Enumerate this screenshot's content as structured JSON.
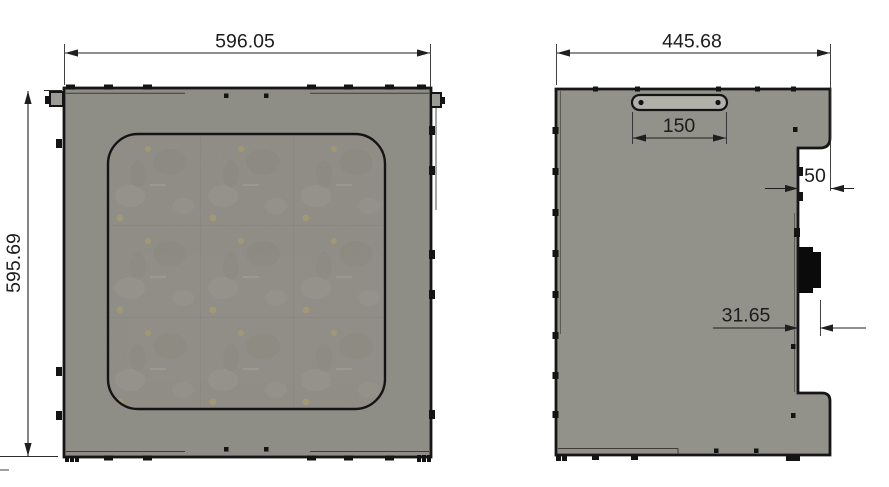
{
  "drawing": {
    "background": "#ffffff",
    "colors": {
      "outline": "#161616",
      "front_panel_fill": "#8e8d86",
      "side_panel_fill": "#92918a",
      "window_fill": "#8f8d85",
      "window_border": "#141414",
      "handle_fill": "#b2b1a9",
      "hardware_fill": "#9b9a93",
      "connector_fill": "#0b0b0b",
      "dim_line": "#1f1f1f",
      "dim_text": "#1c1c1c"
    },
    "dimensions": {
      "front_width": "596.05",
      "front_height": "595.69",
      "side_width": "445.68",
      "handle_width": "150",
      "notch_depth": "50",
      "connector_offset": "31.65"
    }
  }
}
